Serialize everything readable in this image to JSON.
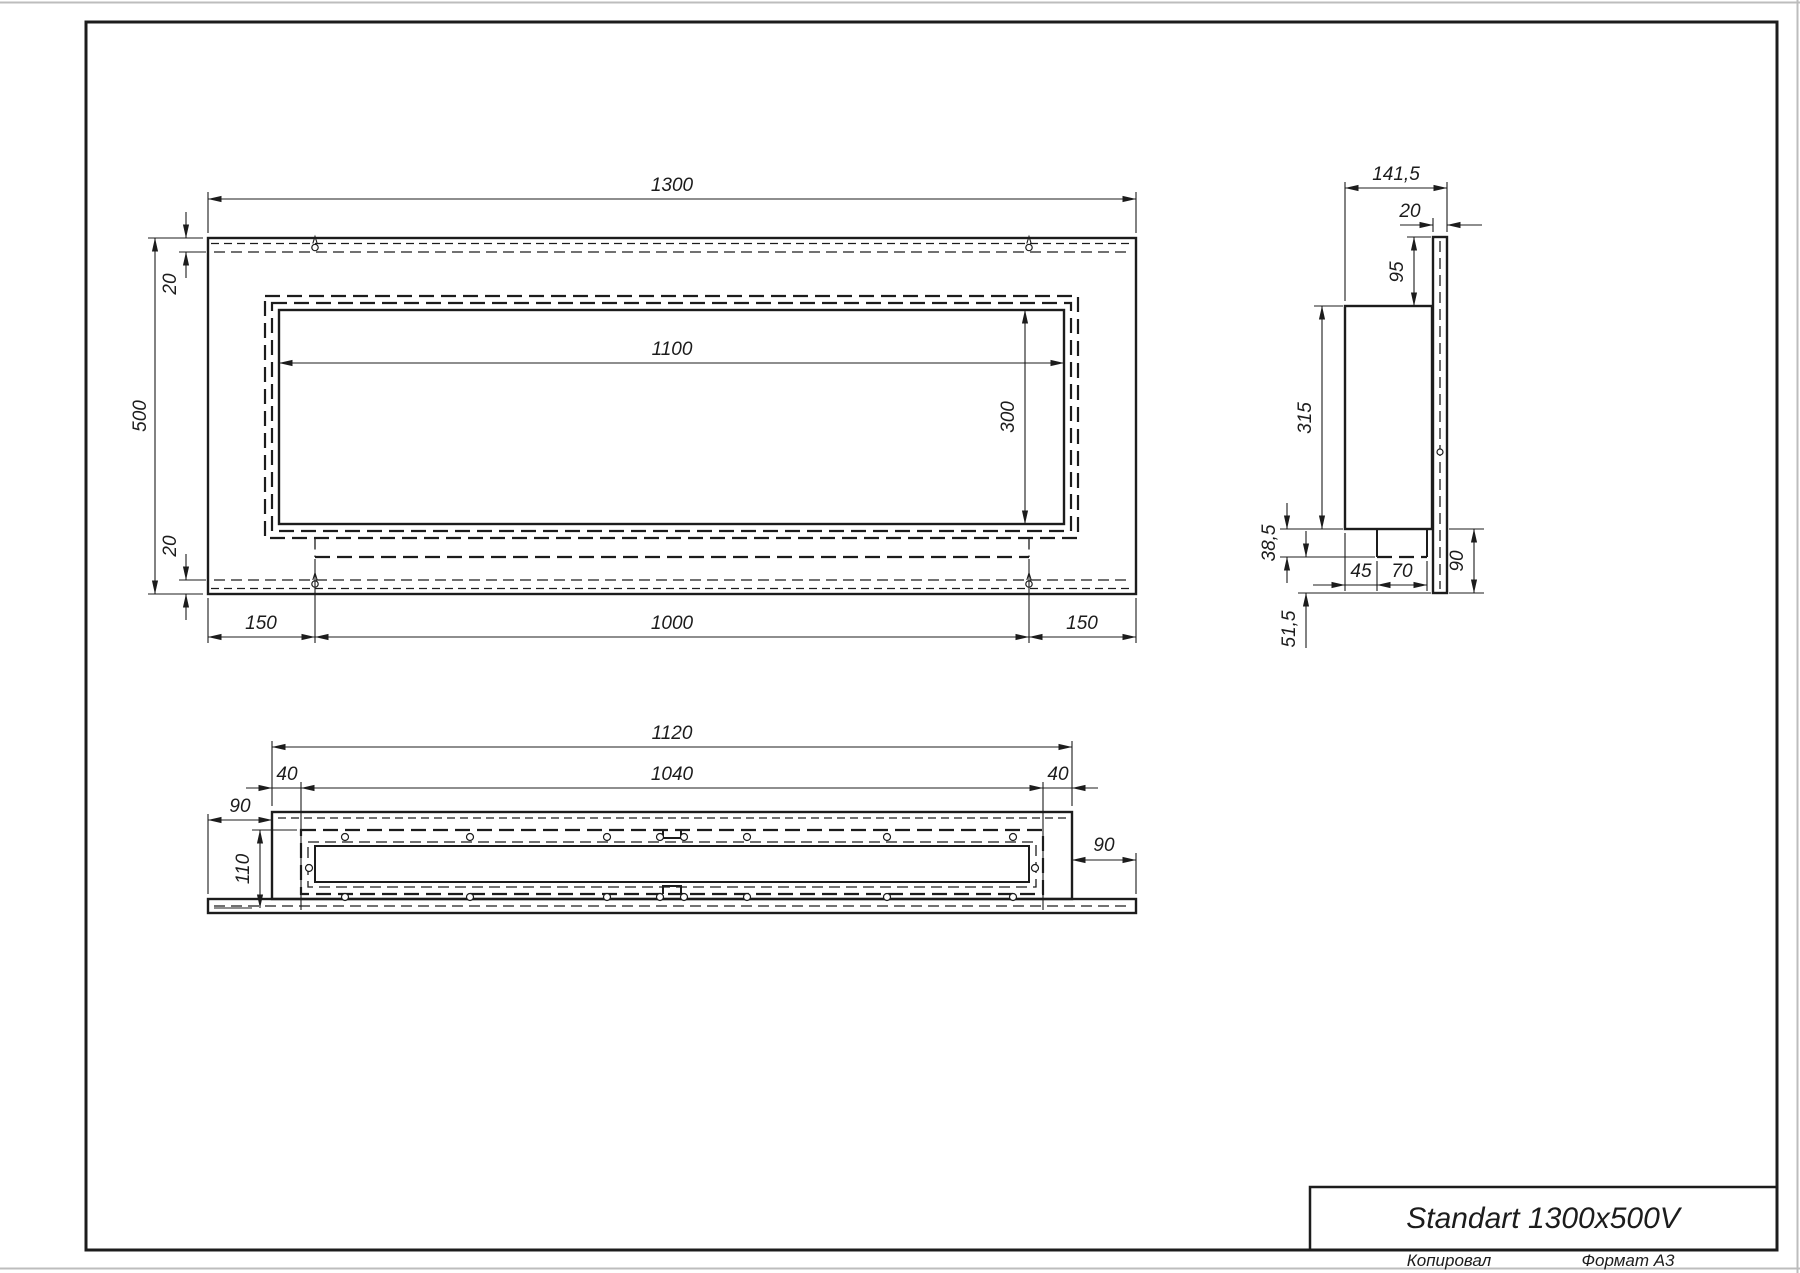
{
  "colors": {
    "ink": "#1c1c1c",
    "paper": "#ffffff",
    "sheet_edge": "#bdbdbd"
  },
  "title_block": {
    "product_name": "Standart 1300x500V",
    "copied_by_label": "Копировал",
    "format_label": "Формат А3"
  },
  "front_view": {
    "overall_width": "1300",
    "overall_height": "500",
    "top_inset": "20",
    "bottom_inset": "20",
    "opening_width": "1100",
    "opening_height": "300",
    "left_span": "150",
    "center_span": "1000",
    "right_span": "150"
  },
  "side_view": {
    "overall_depth": "141,5",
    "flange_thickness": "20",
    "flange_top_overhang": "95",
    "box_height": "315",
    "tray_drop": "38,5",
    "tray_offset": "45",
    "tray_width": "70",
    "flange_bottom_overhang": "90",
    "bottom_margin": "51,5"
  },
  "bottom_view": {
    "box_width": "1120",
    "opening_width": "1040",
    "left_wall": "40",
    "right_wall": "40",
    "left_flange_overhang": "90",
    "opening_depth": "110",
    "right_flange_overhang": "90"
  }
}
